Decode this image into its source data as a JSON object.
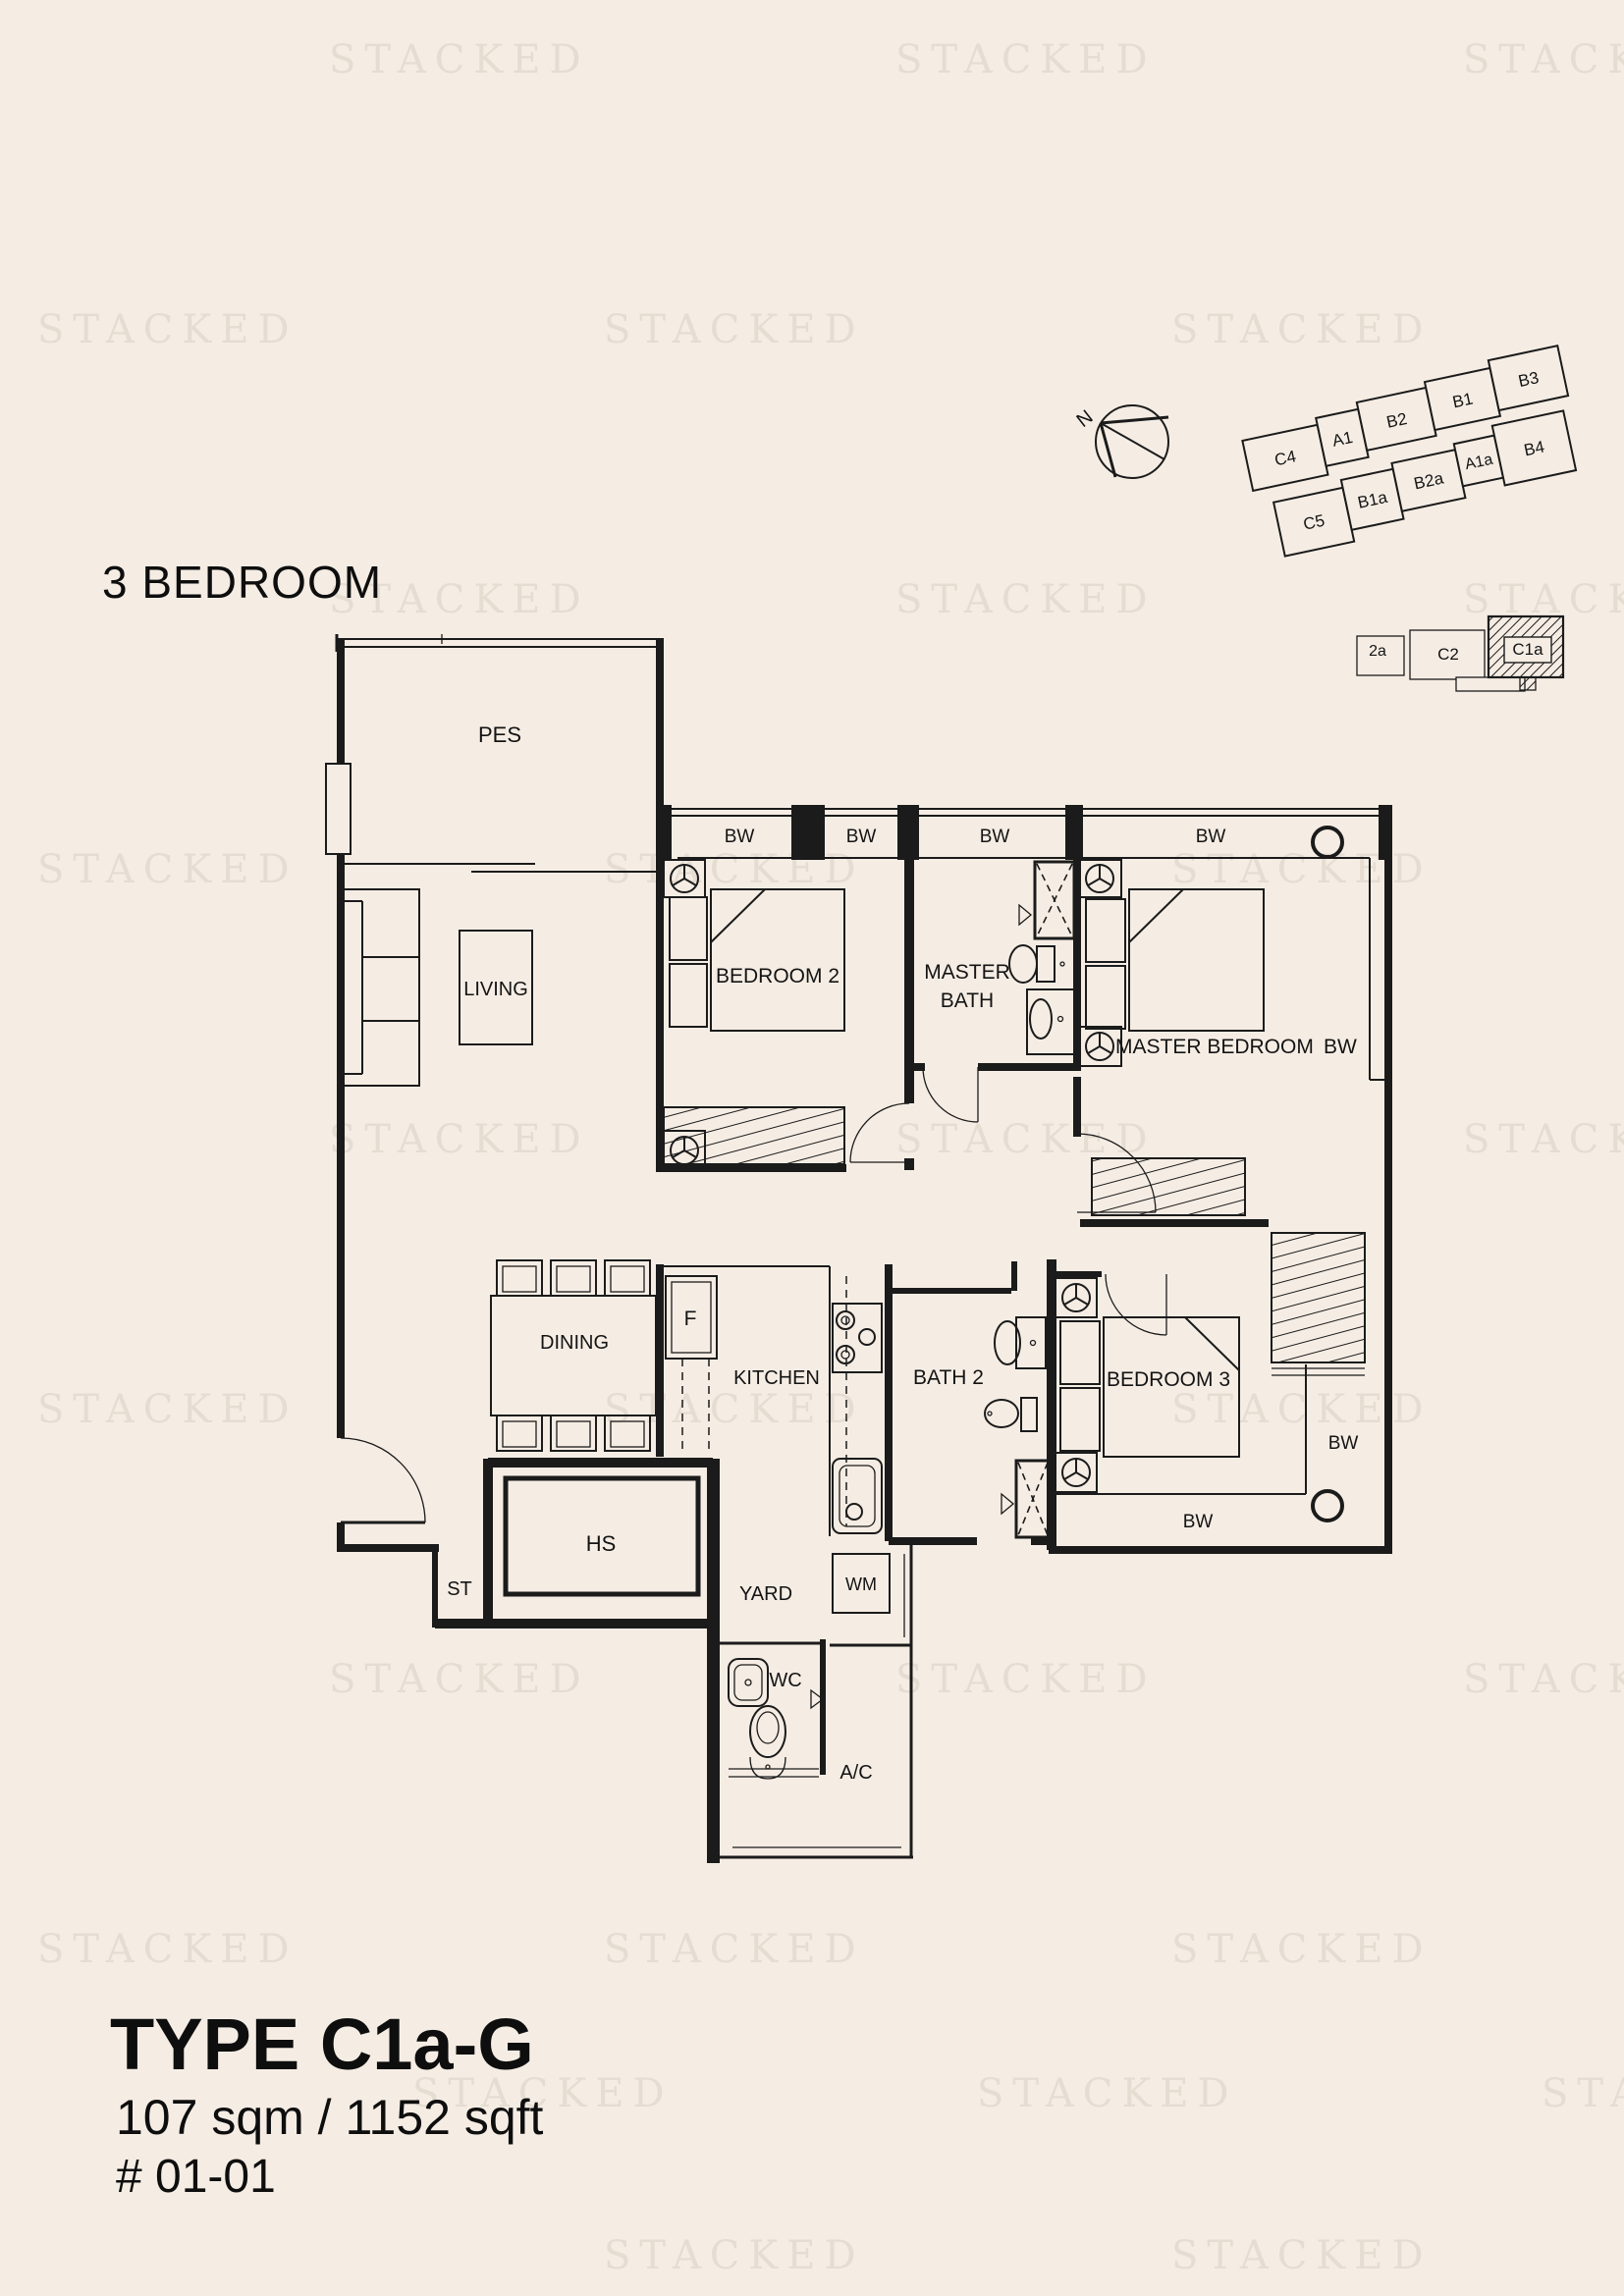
{
  "watermark": {
    "text": "STACKED"
  },
  "header": {
    "title": "3 BEDROOM"
  },
  "site_plan": {
    "compass_label": "N",
    "blocks": {
      "c4": "C4",
      "a1": "A1",
      "b2": "B2",
      "b1": "B1",
      "b3": "B3",
      "c5": "C5",
      "b1a": "B1a",
      "b2a": "B2a",
      "a1a": "A1a",
      "b4": "B4"
    },
    "mini_blocks": {
      "left_partial": "2a",
      "c2": "C2",
      "c1a": "C1a"
    },
    "highlighted_unit": "C1a"
  },
  "floor_plan": {
    "bw_label": "BW",
    "rooms": {
      "pes": "PES",
      "living": "LIVING",
      "bedroom2": "BEDROOM 2",
      "master_bath_line1": "MASTER",
      "master_bath_line2": "BATH",
      "master_bedroom": "MASTER BEDROOM",
      "dining": "DINING",
      "fridge": "F",
      "kitchen": "KITCHEN",
      "bath2": "BATH 2",
      "bedroom3": "BEDROOM 3",
      "hs": "HS",
      "st": "ST",
      "yard": "YARD",
      "wm": "WM",
      "wc": "WC",
      "ac": "A/C"
    }
  },
  "footer": {
    "type_label": "TYPE C1a-G",
    "area": "107 sqm / 1152 sqft",
    "unit_number": "# 01-01"
  },
  "colors": {
    "background": "#f5ede4",
    "line": "#1b1b1b",
    "watermark": "#e5dcd2"
  }
}
